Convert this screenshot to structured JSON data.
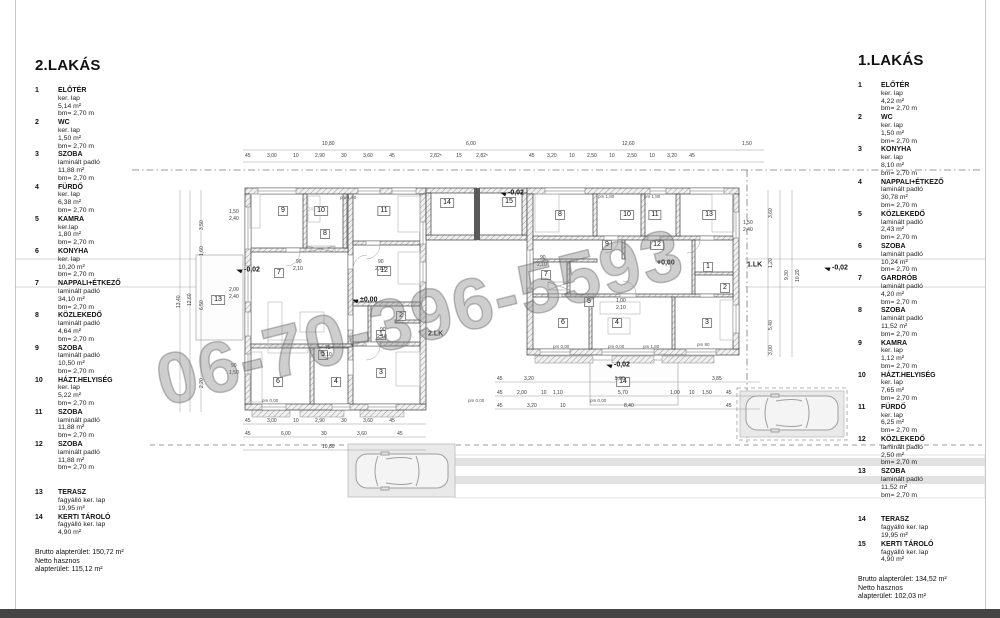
{
  "page": {
    "watermark": "06-70-396-5593"
  },
  "left_apartment": {
    "title": "2.LAKÁS",
    "rooms": [
      {
        "no": "1",
        "name": "ELŐTÉR",
        "lines": [
          "ker. lap",
          "5,14 m²",
          "bm= 2,70 m"
        ]
      },
      {
        "no": "2",
        "name": "WC",
        "lines": [
          "ker. lap",
          "1,50 m²",
          "bm= 2,70 m"
        ]
      },
      {
        "no": "3",
        "name": "SZOBA",
        "lines": [
          "laminált padló",
          "11,88 m²",
          "bm= 2,70 m"
        ]
      },
      {
        "no": "4",
        "name": "FÜRDŐ",
        "lines": [
          "ker. lap",
          "6,38 m²",
          "bm= 2,70 m"
        ]
      },
      {
        "no": "5",
        "name": "KAMRA",
        "lines": [
          "ker.lap",
          "1,80 m²",
          "bm= 2,70 m"
        ]
      },
      {
        "no": "6",
        "name": "KONYHA",
        "lines": [
          "ker. lap",
          "10,20 m²",
          "bm= 2,70 m"
        ]
      },
      {
        "no": "7",
        "name": "NAPPALI+ÉTKEZŐ",
        "lines": [
          "laminált padló",
          "34,10 m²",
          "bm= 2,70 m"
        ]
      },
      {
        "no": "8",
        "name": "KÖZLEKEDŐ",
        "lines": [
          "laminált padló",
          "4,64 m²",
          "bm= 2,70 m"
        ]
      },
      {
        "no": "9",
        "name": "SZOBA",
        "lines": [
          "laminált padló",
          "10,50 m²",
          "bm= 2,70 m"
        ]
      },
      {
        "no": "10",
        "name": "HÁZT.HELYISÉG",
        "lines": [
          "ker. lap",
          "5,22 m²",
          "bm= 2,70 m"
        ]
      },
      {
        "no": "11",
        "name": "SZOBA",
        "lines": [
          "laminált padló",
          "11,88 m²",
          "bm= 2,70 m"
        ]
      },
      {
        "no": "12",
        "name": "SZOBA",
        "lines": [
          "laminált padló",
          "11,88 m²",
          "bm= 2,70 m"
        ]
      },
      {
        "no": "13",
        "name": "TERASZ",
        "gap": true,
        "lines": [
          "fagyálló ker. lap",
          "19,95 m²"
        ]
      },
      {
        "no": "14",
        "name": "KERTI TÁROLÓ",
        "lines": [
          "fagyálló ker. lap",
          "4,90 m²"
        ]
      }
    ],
    "totals": [
      "Brutto alapterület: 150,72 m²",
      "Netto hasznos",
      "alapterület: 115,12 m²"
    ]
  },
  "right_apartment": {
    "title": "1.LAKÁS",
    "rooms": [
      {
        "no": "1",
        "name": "ELŐTÉR",
        "lines": [
          "ker. lap",
          "4,22 m²",
          "bm= 2,70 m"
        ]
      },
      {
        "no": "2",
        "name": "WC",
        "lines": [
          "ker. lap",
          "1,50 m²",
          "bm= 2,70 m"
        ]
      },
      {
        "no": "3",
        "name": "KONYHA",
        "lines": [
          "ker. lap",
          "8,10 m²",
          "bm= 2,70 m"
        ]
      },
      {
        "no": "4",
        "name": "NAPPALI+ÉTKEZŐ",
        "lines": [
          "laminált padló",
          "30,78 m²",
          "bm= 2,70 m"
        ]
      },
      {
        "no": "5",
        "name": "KÖZLEKEDŐ",
        "lines": [
          "laminált padló",
          "2,43 m²",
          "bm= 2,70 m"
        ]
      },
      {
        "no": "6",
        "name": "SZOBA",
        "lines": [
          "laminált padló",
          "10,24 m²",
          "bm= 2,70 m"
        ]
      },
      {
        "no": "7",
        "name": "GARDRÓB",
        "lines": [
          "laminált padló",
          "4,20 m²",
          "bm= 2,70 m"
        ]
      },
      {
        "no": "8",
        "name": "SZOBA",
        "lines": [
          "laminált padló",
          "11,52 m²",
          "bm= 2,70 m"
        ]
      },
      {
        "no": "9",
        "name": "KAMRA",
        "lines": [
          "ker. lap",
          "1,12 m²",
          "bm= 2,70 m"
        ]
      },
      {
        "no": "10",
        "name": "HÁZT.HELYISÉG",
        "lines": [
          "ker. lap",
          "7,65 m²",
          "bm= 2,70 m"
        ]
      },
      {
        "no": "11",
        "name": "FÜRDŐ",
        "lines": [
          "ker. lap",
          "6,25 m²",
          "bm= 2,70 m"
        ]
      },
      {
        "no": "12",
        "name": "KÖZLEKEDŐ",
        "lines": [
          "laminált padló",
          "2,50 m²",
          "bm= 2,70 m"
        ]
      },
      {
        "no": "13",
        "name": "SZOBA",
        "lines": [
          "laminált padló",
          "11,52 m²",
          "bm= 2,70 m"
        ]
      },
      {
        "no": "14",
        "name": "TERASZ",
        "gap": true,
        "lines": [
          "fagyálló ker. lap",
          "19,95 m²"
        ]
      },
      {
        "no": "15",
        "name": "KERTI TÁROLÓ",
        "lines": [
          "fagyálló ker. lap",
          "4,90 m²"
        ]
      }
    ],
    "totals": [
      "Brutto alapterület: 134,52 m²",
      "Netto hasznos",
      "alapterület: 102,03 m²"
    ]
  },
  "floorplan": {
    "left_rooms": [
      {
        "n": "9",
        "x": 283,
        "y": 211
      },
      {
        "n": "10",
        "x": 321,
        "y": 211
      },
      {
        "n": "11",
        "x": 384,
        "y": 211
      },
      {
        "n": "8",
        "x": 325,
        "y": 234
      },
      {
        "n": "7",
        "x": 279,
        "y": 273
      },
      {
        "n": "12",
        "x": 384,
        "y": 271
      },
      {
        "n": "2",
        "x": 401,
        "y": 316
      },
      {
        "n": "1",
        "x": 381,
        "y": 335
      },
      {
        "n": "5",
        "x": 323,
        "y": 355
      },
      {
        "n": "4",
        "x": 336,
        "y": 382
      },
      {
        "n": "6",
        "x": 278,
        "y": 382
      },
      {
        "n": "3",
        "x": 381,
        "y": 373
      },
      {
        "n": "13",
        "x": 218,
        "y": 300
      },
      {
        "n": "14",
        "x": 447,
        "y": 203
      }
    ],
    "right_rooms": [
      {
        "n": "8",
        "x": 560,
        "y": 215
      },
      {
        "n": "10",
        "x": 627,
        "y": 215
      },
      {
        "n": "11",
        "x": 655,
        "y": 215
      },
      {
        "n": "13",
        "x": 709,
        "y": 215
      },
      {
        "n": "9",
        "x": 607,
        "y": 245
      },
      {
        "n": "12",
        "x": 657,
        "y": 245
      },
      {
        "n": "7",
        "x": 546,
        "y": 275
      },
      {
        "n": "1",
        "x": 708,
        "y": 267
      },
      {
        "n": "2",
        "x": 725,
        "y": 288
      },
      {
        "n": "5",
        "x": 589,
        "y": 302
      },
      {
        "n": "6",
        "x": 563,
        "y": 323
      },
      {
        "n": "4",
        "x": 617,
        "y": 323
      },
      {
        "n": "3",
        "x": 707,
        "y": 323
      },
      {
        "n": "14",
        "x": 623,
        "y": 382
      },
      {
        "n": "15",
        "x": 509,
        "y": 202
      }
    ],
    "elevations": [
      {
        "t": "-0,02",
        "x": 236,
        "y": 270,
        "flag": 1
      },
      {
        "t": "±0,00",
        "x": 352,
        "y": 300,
        "flag": 1
      },
      {
        "t": "-0,02",
        "x": 500,
        "y": 193,
        "flag": 1
      },
      {
        "t": "+0,00",
        "x": 657,
        "y": 263
      },
      {
        "t": "-0,02",
        "x": 606,
        "y": 365,
        "flag": 1
      },
      {
        "t": "-0,02",
        "x": 824,
        "y": 268,
        "flag": 1
      }
    ],
    "lk_labels": [
      {
        "t": "2.LK",
        "x": 428,
        "y": 334
      },
      {
        "t": "1.LK",
        "x": 747,
        "y": 265
      }
    ],
    "pm_labels": [
      {
        "t": "pm 1,80",
        "x": 340,
        "y": 195
      },
      {
        "t": "pm 1,80",
        "x": 598,
        "y": 194
      },
      {
        "t": "pm 1,80",
        "x": 644,
        "y": 194
      },
      {
        "t": "pm 0,00",
        "x": 262,
        "y": 398
      },
      {
        "t": "pm 0,00",
        "x": 468,
        "y": 398
      },
      {
        "t": "pm 0,00",
        "x": 590,
        "y": 398
      },
      {
        "t": "pm 0,00",
        "x": 553,
        "y": 344
      },
      {
        "t": "pm 0,00",
        "x": 608,
        "y": 344
      },
      {
        "t": "pm 1,80",
        "x": 643,
        "y": 344
      },
      {
        "t": "pm 90",
        "x": 697,
        "y": 342
      }
    ],
    "dims": [
      {
        "t": "10,80",
        "x": 322,
        "y": 141
      },
      {
        "t": "6,00",
        "x": 466,
        "y": 141
      },
      {
        "t": "12,60",
        "x": 622,
        "y": 141
      },
      {
        "t": "1,50",
        "x": 742,
        "y": 141
      },
      {
        "t": "45 3,00 10 2,90 30 3,60 45",
        "x": 245,
        "y": 153,
        "ws": 15
      },
      {
        "t": "2,82⁵ 15 2,82⁵",
        "x": 430,
        "y": 153,
        "ws": 13
      },
      {
        "t": "45 3,20 10 2,50 10 2,50 10 3,20 45",
        "x": 529,
        "y": 153,
        "ws": 11
      },
      {
        "t": "45 3,00 10 2,90 30 3,60 45",
        "x": 245,
        "y": 418,
        "ws": 15
      },
      {
        "t": "45 6,00 30 3,60 45",
        "x": 245,
        "y": 431,
        "ws": 29
      },
      {
        "t": "10,80",
        "x": 322,
        "y": 444
      },
      {
        "t": "45",
        "x": 497,
        "y": 376
      },
      {
        "t": "3,20",
        "x": 524,
        "y": 376
      },
      {
        "t": "5,00",
        "x": 615,
        "y": 376
      },
      {
        "t": "3,85",
        "x": 712,
        "y": 376
      },
      {
        "t": "45",
        "x": 497,
        "y": 390
      },
      {
        "t": "2,00",
        "x": 517,
        "y": 390
      },
      {
        "t": "10",
        "x": 541,
        "y": 390
      },
      {
        "t": "1,10",
        "x": 553,
        "y": 390
      },
      {
        "t": "5,70",
        "x": 618,
        "y": 390
      },
      {
        "t": "1,00",
        "x": 670,
        "y": 390
      },
      {
        "t": "10",
        "x": 689,
        "y": 390
      },
      {
        "t": "1,50",
        "x": 702,
        "y": 390
      },
      {
        "t": "45",
        "x": 726,
        "y": 390
      },
      {
        "t": "45",
        "x": 497,
        "y": 403
      },
      {
        "t": "3,20",
        "x": 527,
        "y": 403
      },
      {
        "t": "10",
        "x": 560,
        "y": 403
      },
      {
        "t": "8,40",
        "x": 624,
        "y": 403
      },
      {
        "t": "45",
        "x": 726,
        "y": 403
      },
      {
        "t": "1,50",
        "x": 229,
        "y": 209
      },
      {
        "t": "2,40",
        "x": 229,
        "y": 216
      },
      {
        "t": "2,00",
        "x": 229,
        "y": 287
      },
      {
        "t": "2,40",
        "x": 229,
        "y": 294
      },
      {
        "t": "90",
        "x": 231,
        "y": 363
      },
      {
        "t": "1,50",
        "x": 229,
        "y": 370
      },
      {
        "t": "1,50",
        "x": 743,
        "y": 220
      },
      {
        "t": "2,40",
        "x": 743,
        "y": 227
      },
      {
        "t": "90",
        "x": 296,
        "y": 259
      },
      {
        "t": "2,10",
        "x": 293,
        "y": 266
      },
      {
        "t": "90",
        "x": 378,
        "y": 259
      },
      {
        "t": "2,10",
        "x": 375,
        "y": 266
      },
      {
        "t": "90",
        "x": 380,
        "y": 327
      },
      {
        "t": "2,10",
        "x": 377,
        "y": 334
      },
      {
        "t": "75",
        "x": 325,
        "y": 345
      },
      {
        "t": "2,10",
        "x": 322,
        "y": 352
      },
      {
        "t": "90",
        "x": 540,
        "y": 255
      },
      {
        "t": "2,10",
        "x": 537,
        "y": 262
      },
      {
        "t": "1,00",
        "x": 616,
        "y": 298
      },
      {
        "t": "2,10",
        "x": 616,
        "y": 305
      }
    ],
    "vdims": [
      {
        "t": "13,40",
        "x": 176,
        "y": 308
      },
      {
        "t": "12,60",
        "x": 187,
        "y": 306
      },
      {
        "t": "3,50",
        "x": 199,
        "y": 230
      },
      {
        "t": "1,60",
        "x": 199,
        "y": 256
      },
      {
        "t": "6,50",
        "x": 199,
        "y": 310
      },
      {
        "t": "2,20",
        "x": 199,
        "y": 388
      },
      {
        "t": "9,30",
        "x": 784,
        "y": 280
      },
      {
        "t": "10,20",
        "x": 795,
        "y": 282
      },
      {
        "t": "3,60",
        "x": 768,
        "y": 218
      },
      {
        "t": "1,20",
        "x": 768,
        "y": 268
      },
      {
        "t": "5,40",
        "x": 768,
        "y": 330
      },
      {
        "t": "3,00",
        "x": 768,
        "y": 355
      }
    ]
  }
}
